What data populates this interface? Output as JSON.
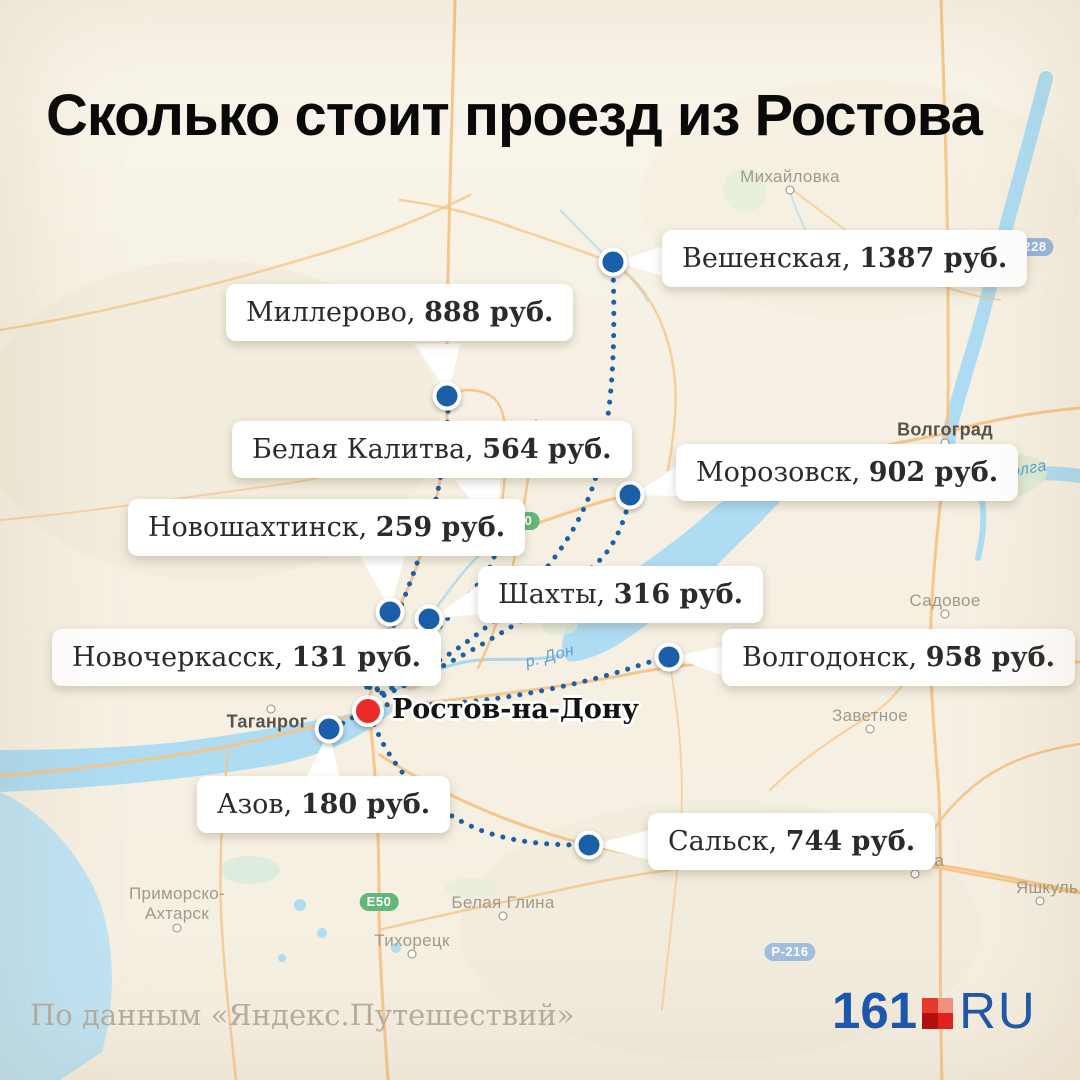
{
  "title": "Сколько стоит проезд из Ростова",
  "attribution": "По данным «Яндекс.Путешествий»",
  "origin": {
    "name": "Ростов-на-Дону"
  },
  "destinations": [
    {
      "name": "Вешенская,",
      "price": "1387 руб."
    },
    {
      "name": "Миллерово,",
      "price": "888 руб."
    },
    {
      "name": "Белая Калитва,",
      "price": "564 руб."
    },
    {
      "name": "Морозовск,",
      "price": "902 руб."
    },
    {
      "name": "Новошахтинск,",
      "price": "259 руб."
    },
    {
      "name": "Шахты,",
      "price": "316 руб."
    },
    {
      "name": "Новочеркасск,",
      "price": "131 руб."
    },
    {
      "name": "Волгодонск,",
      "price": "958 руб."
    },
    {
      "name": "Азов,",
      "price": "180 руб."
    },
    {
      "name": "Сальск,",
      "price": "744 руб."
    }
  ],
  "map_labels": {
    "mikhaylovka": "Михайловка",
    "volgograd": "Волгоград",
    "volga_river": "р. Волга",
    "sadovoye": "Садовое",
    "zavetnoye": "Заветное",
    "elista": "Элиста",
    "yashkul": "Яшкуль",
    "taganrog": "Таганрог",
    "primorsko_line1": "Приморско-",
    "primorsko_line2": "Ахтарск",
    "belaya_glina": "Белая Глина",
    "tikhoretsk": "Тихорецк",
    "don_river": "р. Дон"
  },
  "road_badges": {
    "e40": "Е40",
    "e50": "Е50",
    "r228": "Р-228",
    "r216": "Р-216"
  },
  "logo": {
    "number": "161",
    "suffix": "RU"
  },
  "colors": {
    "route_blue": "#1b5fa8",
    "origin_red": "#ea2b27",
    "logo_blue": "#1a57b0",
    "background": "#f6f1e4",
    "water": "#aedcf2",
    "road_orange": "#f6c488"
  }
}
